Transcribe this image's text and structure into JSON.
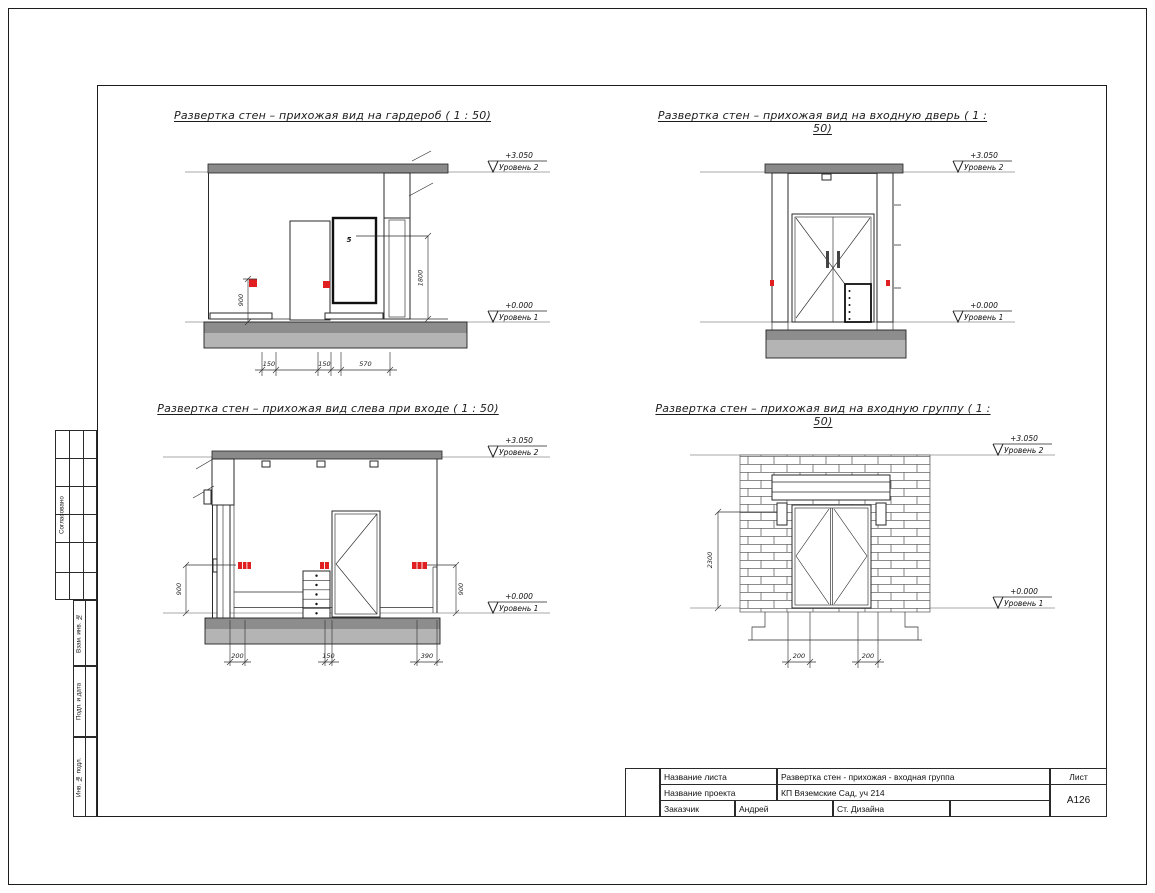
{
  "sheet": {
    "levels": {
      "upper": {
        "value": "+3.050",
        "name": "Уровень 2"
      },
      "lower": {
        "value": "+0.000",
        "name": "Уровень 1"
      }
    },
    "views": [
      {
        "title": "Развертка стен – прихожая вид на гардероб ( 1 : 50)",
        "annotation": "5",
        "dims": {
          "bottom": [
            "150",
            "150",
            "570"
          ],
          "vertical": [
            "900",
            "1800"
          ]
        }
      },
      {
        "title": "Развертка стен – прихожая вид на входную дверь ( 1 : 50)",
        "dims": {
          "bottom": [],
          "vertical": []
        }
      },
      {
        "title": "Развертка стен – прихожая вид слева при входе ( 1 : 50)",
        "dims": {
          "bottom": [
            "200",
            "150",
            "390"
          ],
          "vertical": [
            "900",
            "900"
          ]
        }
      },
      {
        "title": "Развертка стен – прихожая вид на входную группу ( 1 : 50)",
        "dims": {
          "bottom": [
            "200",
            "200"
          ],
          "vertical": [
            "2300"
          ]
        }
      }
    ],
    "side_stamp": {
      "items": [
        "Согласовано",
        "Взам. инв. №",
        "Подп. и дата",
        "Инв. № подл."
      ]
    },
    "title_block": {
      "row1_label": "Название листа",
      "row1_value": "Развертка стен - прихожая - входная группа",
      "row2_label": "Название проекта",
      "row2_value": "КП Вяземские Сад, уч 214",
      "row3_label": "Заказчик",
      "row3_value1": "Андрей",
      "row3_value2": "Ст. Дизайна",
      "sheet_label": "Лист",
      "sheet_number": "А126"
    },
    "colors": {
      "accent_red": "#e02020",
      "floor_gray": "#b4b4b4",
      "ceiling_gray": "#8a8a8a"
    }
  }
}
